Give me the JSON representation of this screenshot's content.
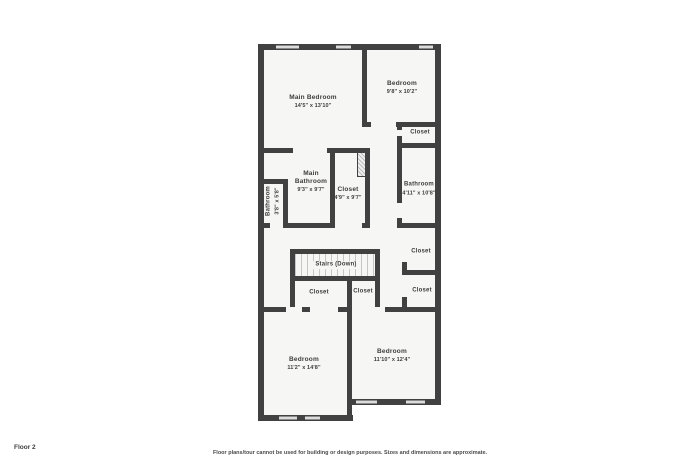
{
  "floor_label": "Floor 2",
  "disclaimer": "Floor plans/tour cannot be used for building or design purposes. Sizes and dimensions are approximate.",
  "rooms": {
    "main_bedroom": {
      "name": "Main Bedroom",
      "dims": "14'5\" x 13'10\""
    },
    "bedroom_top": {
      "name": "Bedroom",
      "dims": "9'8\" x 10'2\""
    },
    "closet_top_right": {
      "name": "Closet"
    },
    "main_bathroom": {
      "name": "Main Bathroom",
      "dims": "9'3\" x 9'7\""
    },
    "closet_main": {
      "name": "Closet",
      "dims": "4'9\" x 9'7\""
    },
    "bathroom_small": {
      "name": "Bathroom",
      "dims": "3'8\" x 5'8\""
    },
    "bathroom_right": {
      "name": "Bathroom",
      "dims": "4'11\" x 10'8\""
    },
    "closet_hall_upper": {
      "name": "Closet"
    },
    "closet_hall_lower": {
      "name": "Closet"
    },
    "stairs": {
      "name": "Stairs (Down)"
    },
    "closet_bedroom_left": {
      "name": "Closet"
    },
    "closet_bedroom_right": {
      "name": "Closet"
    },
    "bedroom_bottom_left": {
      "name": "Bedroom",
      "dims": "11'2\" x 14'8\""
    },
    "bedroom_bottom_right": {
      "name": "Bedroom",
      "dims": "11'10\" x 12'4\""
    }
  },
  "colors": {
    "wall": "#414141",
    "room_fill": "#f6f6f5",
    "window_fill": "#dcdcdc",
    "text": "#3d3d3d"
  }
}
